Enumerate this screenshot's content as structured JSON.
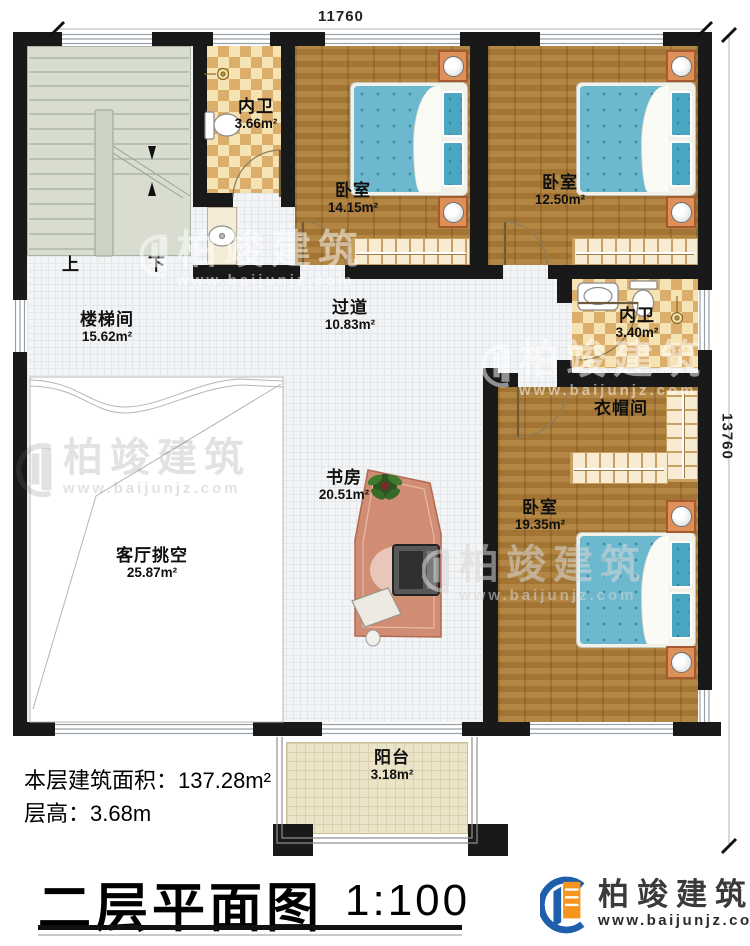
{
  "dimensions": {
    "top": "11760",
    "right": "13760"
  },
  "rooms": [
    {
      "name": "楼梯间",
      "area": "15.62m²"
    },
    {
      "name": "内卫",
      "area": "3.66m²"
    },
    {
      "name": "卧室",
      "area": "14.15m²"
    },
    {
      "name": "卧室",
      "area": "12.50m²"
    },
    {
      "name": "内卫",
      "area": "3.40m²"
    },
    {
      "name": "衣帽间",
      "area": ""
    },
    {
      "name": "卧室",
      "area": "19.35m²"
    },
    {
      "name": "过道",
      "area": "10.83m²"
    },
    {
      "name": "书房",
      "area": "20.51m²"
    },
    {
      "name": "客厅挑空",
      "area": "25.87m²"
    },
    {
      "name": "阳台",
      "area": "3.18m²"
    }
  ],
  "stairs": {
    "up_label": "上",
    "down_label": "下"
  },
  "info": {
    "area_label": "本层建筑面积：",
    "area_value": "137.28m²",
    "height_label": "层高：",
    "height_value": "3.68m"
  },
  "title": {
    "text": "二层平面图",
    "scale": "1:100"
  },
  "brand": {
    "name": "柏竣建筑",
    "url": "www.baijunjz.com"
  },
  "watermark": {
    "name": "柏竣建筑",
    "url": "www.baijunjz.com"
  },
  "colors": {
    "wall": "#191919",
    "wood_floor": "#aa7b37",
    "bath_checker": "#dcae6c",
    "stairwell": "#d8ddd0",
    "corridor_tile": "#f3f4f6",
    "balcony": "#ece4c8",
    "bed_blue": "#6cb9cf",
    "nightstand": "#dd9159",
    "desk": "#d18c74",
    "logo_blue": "#1e5eaa",
    "logo_orange": "#f7941d"
  }
}
